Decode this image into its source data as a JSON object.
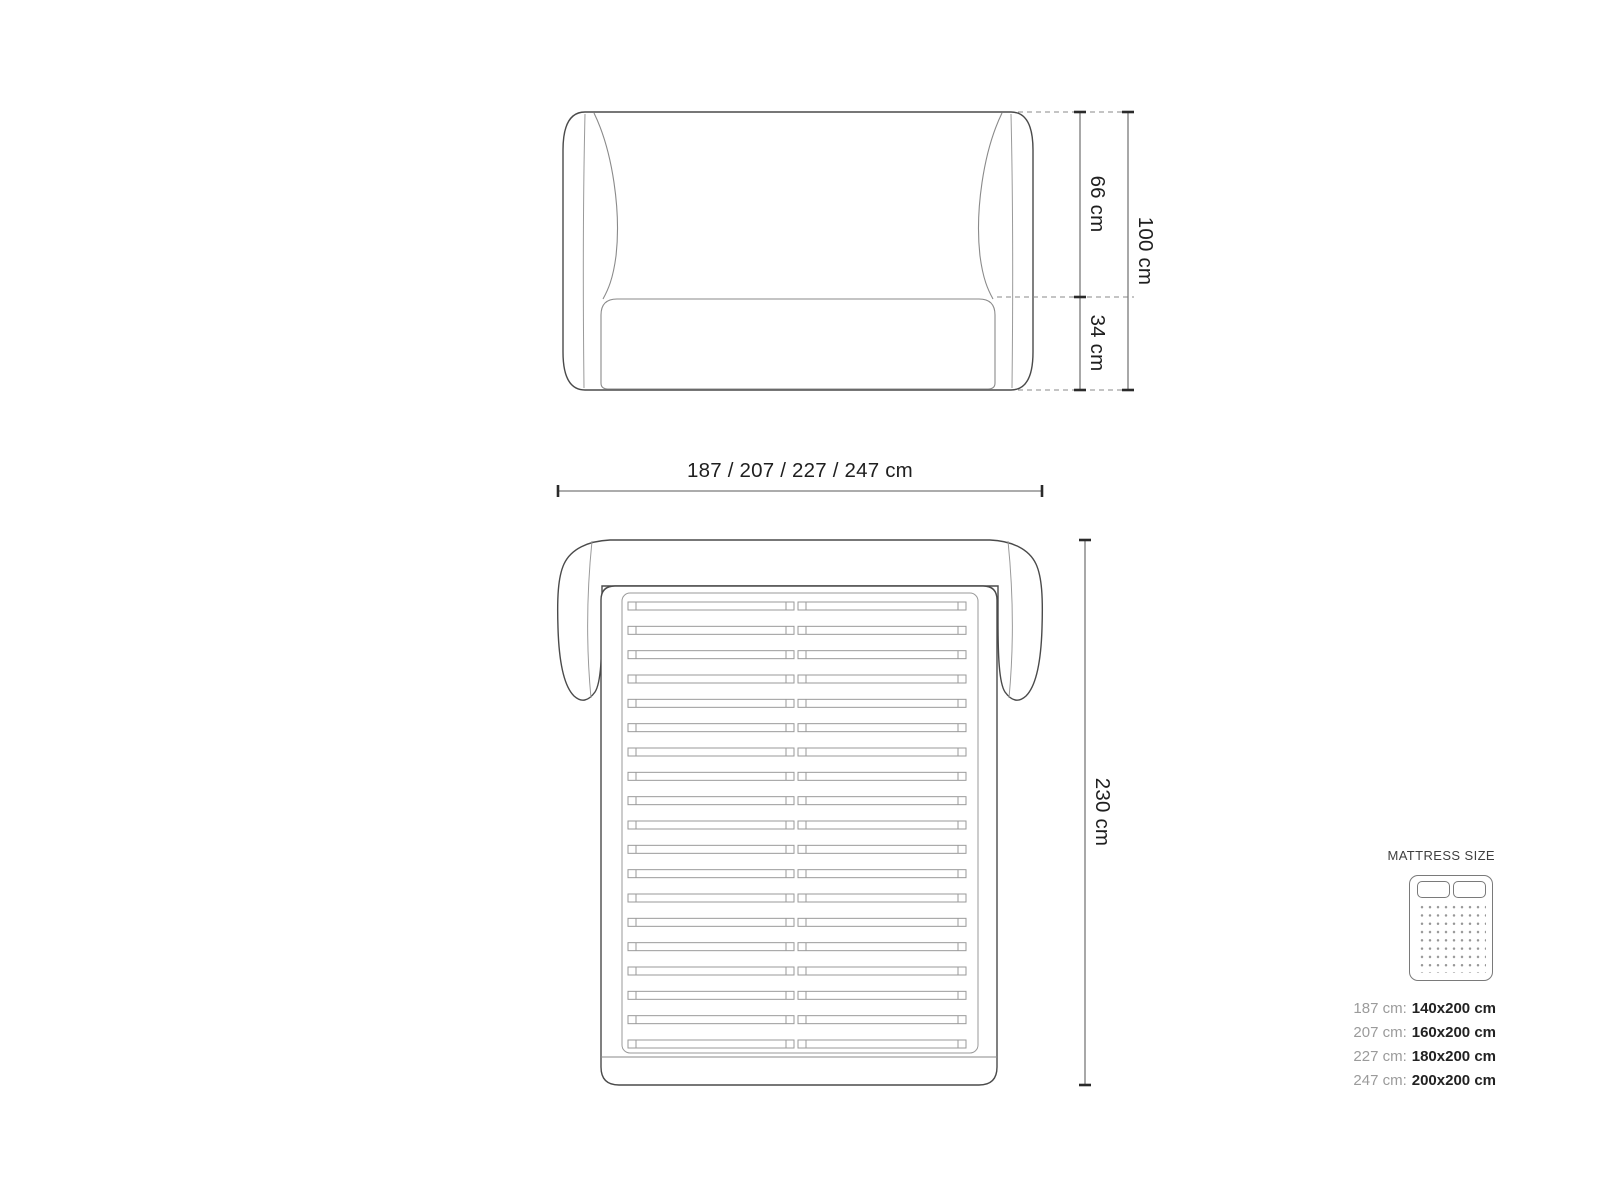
{
  "front_view": {
    "height_upper_label": "66 cm",
    "height_lower_label": "34 cm",
    "height_total_label": "100 cm"
  },
  "width_label": "187 / 207 / 227 / 247 cm",
  "top_view": {
    "depth_label": "230 cm"
  },
  "legend": {
    "title": "MATTRESS SIZE",
    "rows": [
      {
        "frame_width": "187 cm:",
        "mattress_size": "140x200 cm"
      },
      {
        "frame_width": "207 cm:",
        "mattress_size": "160x200 cm"
      },
      {
        "frame_width": "227 cm:",
        "mattress_size": "180x200 cm"
      },
      {
        "frame_width": "247 cm:",
        "mattress_size": "200x200 cm"
      }
    ]
  },
  "colors": {
    "outline_dark": "#4a4a4a",
    "outline_light": "#8f8f8f",
    "dimension_line": "#7a7a7a",
    "dimension_text": "#1f1f1f",
    "legend_key_gray": "#9b9b9b",
    "legend_value_dark": "#222222"
  }
}
